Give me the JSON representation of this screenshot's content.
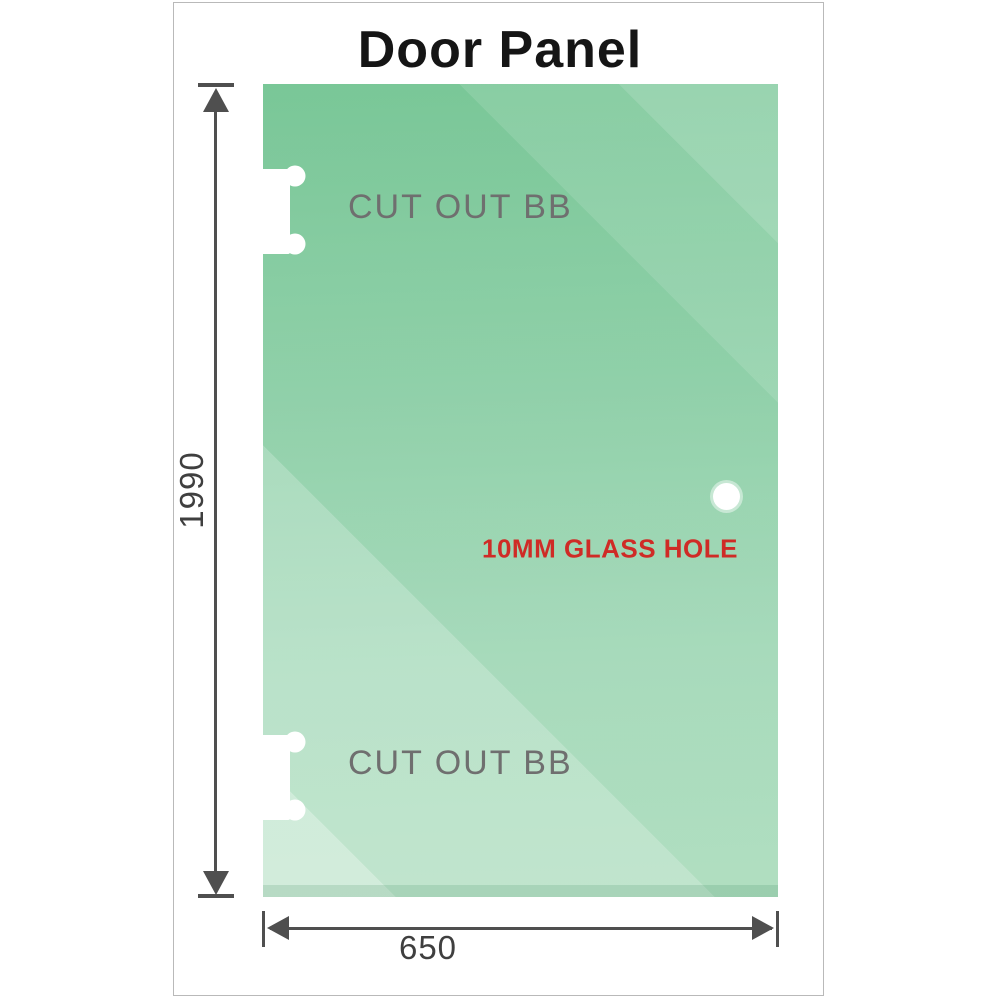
{
  "title": "Door Panel",
  "panel": {
    "cutouts": [
      {
        "label": "CUT OUT BB",
        "position": "top-left"
      },
      {
        "label": "CUT OUT BB",
        "position": "bottom-left"
      }
    ],
    "hole": {
      "label": "10MM GLASS HOLE",
      "diameter_mm": "10"
    }
  },
  "dimensions": {
    "height": {
      "value": "1990"
    },
    "width": {
      "value": "650"
    }
  },
  "colors": {
    "glass_green_dark": "#67bf89",
    "glass_green_light": "#d2ecdb",
    "hole_label_red": "#cf2b26",
    "cutout_label_gray": "#6f6f6f",
    "dimension_gray": "#4f4f4f",
    "card_border": "#b9b9b9",
    "title_black": "#151515"
  }
}
